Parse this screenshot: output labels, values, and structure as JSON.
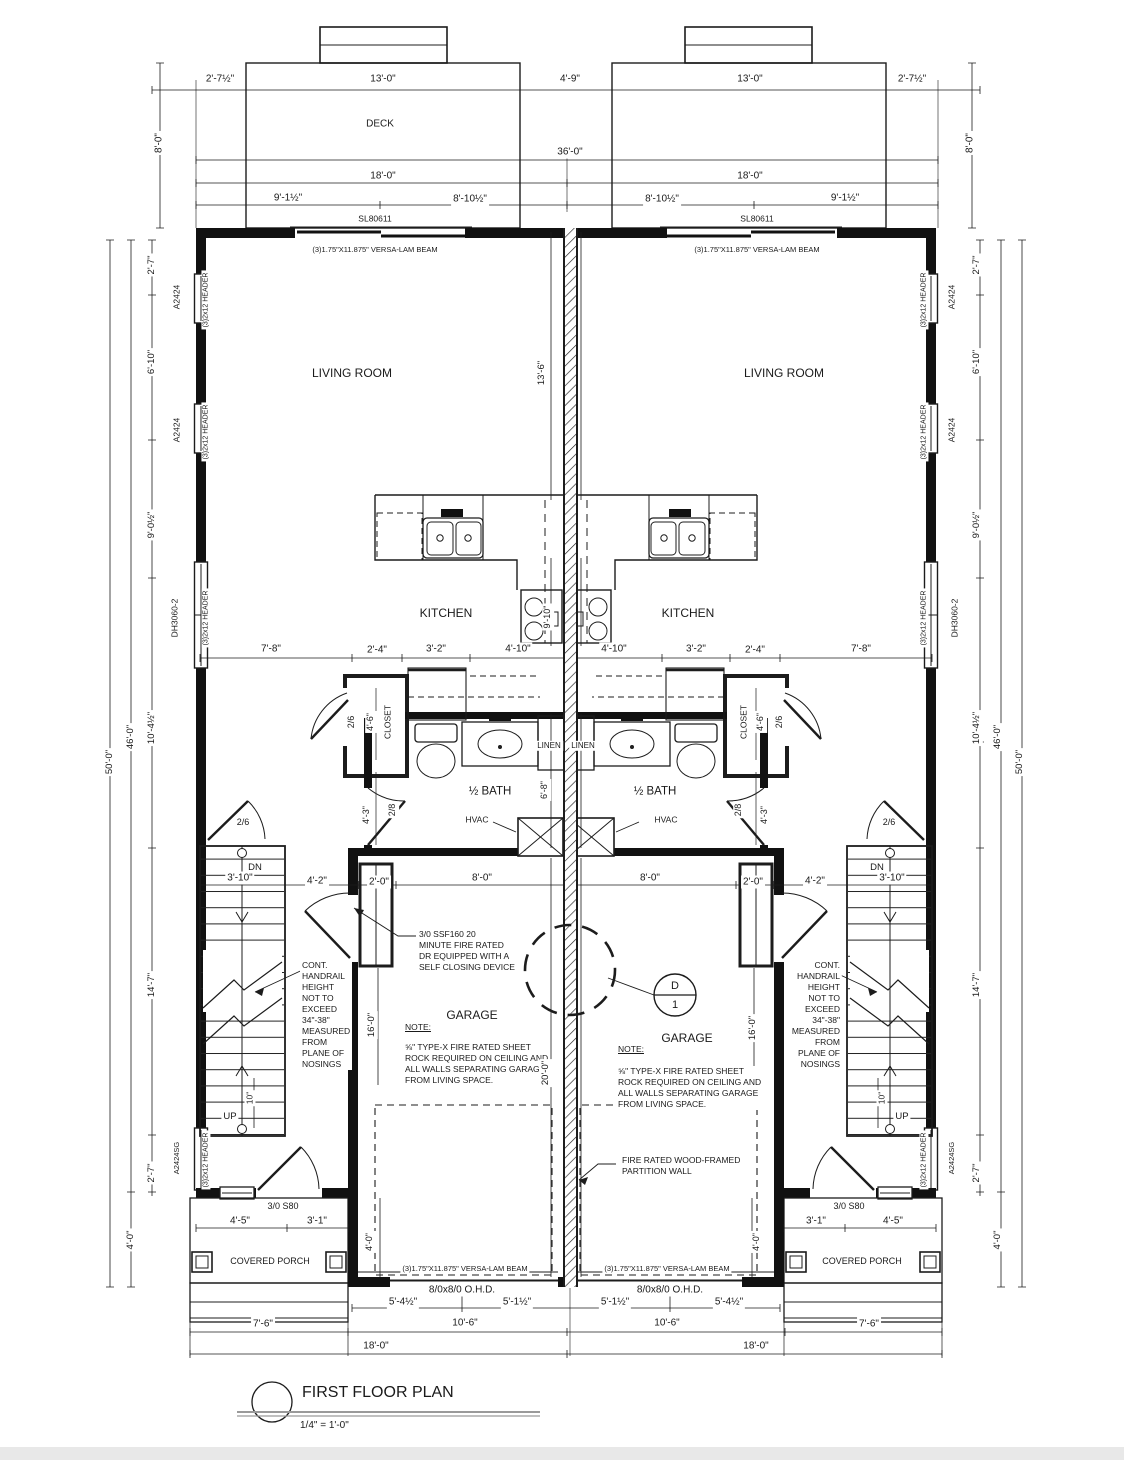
{
  "title": {
    "name": "FIRST FLOOR PLAN",
    "scale": "1/4\" = 1'-0\""
  },
  "rooms": [
    "DECK",
    "LIVING ROOM",
    "KITCHEN",
    "1/2 BATH",
    "CLOSET",
    "LINEN",
    "GARAGE",
    "COVERED PORCH"
  ],
  "notes": {
    "fire_door": "3/0 SSF160 20 MINUTE FIRE RATED DR EQUIPPED WITH A SELF CLOSING DEVICE",
    "garage_note": "5/8\" TYPE-X FIRE RATED SHEET ROCK REQUIRED ON CEILING AND ALL WALLS SEPARATING GARAGE FROM LIVING SPACE.",
    "handrail": "CONT. HANDRAIL HEIGHT NOT TO EXCEED 34\"-38\" MEASURED FROM PLANE OF NOSINGS",
    "partition": "FIRE RATED WOOD-FRAMED PARTITION WALL",
    "beam": "(3)1.75\"X11.875\" VERSA-LAM BEAM",
    "detail_callout": "D/1"
  },
  "labels": [
    {
      "t": "2'-7½\"",
      "x": 220,
      "y": 79
    },
    {
      "t": "13'-0\"",
      "x": 383,
      "y": 79
    },
    {
      "t": "4'-9\"",
      "x": 570,
      "y": 79
    },
    {
      "t": "13'-0\"",
      "x": 750,
      "y": 79
    },
    {
      "t": "2'-7½\"",
      "x": 912,
      "y": 79
    },
    {
      "t": "8'-0\"",
      "x": 159,
      "y": 143,
      "r": -90
    },
    {
      "t": "8'-0\"",
      "x": 970,
      "y": 143,
      "r": -90
    },
    {
      "t": "DECK",
      "x": 380,
      "y": 124,
      "nm": "room-label-deck"
    },
    {
      "t": "36'-0\"",
      "x": 570,
      "y": 152
    },
    {
      "t": "18'-0\"",
      "x": 383,
      "y": 176
    },
    {
      "t": "18'-0\"",
      "x": 750,
      "y": 176
    },
    {
      "t": "9'-1½\"",
      "x": 288,
      "y": 198
    },
    {
      "t": "8'-10½\"",
      "x": 470,
      "y": 199
    },
    {
      "t": "8'-10½\"",
      "x": 662,
      "y": 199
    },
    {
      "t": "9'-1½\"",
      "x": 845,
      "y": 198
    },
    {
      "t": "SL80611",
      "x": 375,
      "y": 219,
      "s": 8.5
    },
    {
      "t": "SL80611",
      "x": 757,
      "y": 219,
      "s": 8.5
    },
    {
      "t": "(3)1.75\"X11.875\" VERSA-LAM BEAM",
      "x": 375,
      "y": 250,
      "s": 7.5
    },
    {
      "t": "(3)1.75\"X11.875\" VERSA-LAM BEAM",
      "x": 757,
      "y": 250,
      "s": 7.5
    },
    {
      "t": "2'-7\"",
      "x": 152,
      "y": 265,
      "r": -90,
      "s": 9.5
    },
    {
      "t": "A2424",
      "x": 177,
      "y": 297,
      "r": -90,
      "s": 8.5
    },
    {
      "t": "(3)2x12 HEADER",
      "x": 206,
      "y": 300,
      "r": -90,
      "s": 7
    },
    {
      "t": "6'-10\"",
      "x": 152,
      "y": 362,
      "r": -90,
      "s": 9.5
    },
    {
      "t": "A2424",
      "x": 177,
      "y": 430,
      "r": -90,
      "s": 8.5
    },
    {
      "t": "(3)2x12 HEADER",
      "x": 206,
      "y": 432,
      "r": -90,
      "s": 7
    },
    {
      "t": "9'-0½\"",
      "x": 152,
      "y": 525,
      "r": -90,
      "s": 9.5
    },
    {
      "t": "DH3060-2",
      "x": 175,
      "y": 618,
      "r": -90,
      "s": 8.5
    },
    {
      "t": "(3)2x12 HEADER",
      "x": 206,
      "y": 618,
      "r": -90,
      "s": 7
    },
    {
      "t": "10'-4½\"",
      "x": 152,
      "y": 728,
      "r": -90,
      "s": 9.5
    },
    {
      "t": "46'-0\"",
      "x": 131,
      "y": 737,
      "r": -90,
      "s": 9.5
    },
    {
      "t": "50'-0\"",
      "x": 110,
      "y": 762,
      "r": -90,
      "s": 9.5
    },
    {
      "t": "14'-7\"",
      "x": 152,
      "y": 985,
      "r": -90,
      "s": 9.5
    },
    {
      "t": "A2424SG",
      "x": 177,
      "y": 1158,
      "r": -90,
      "s": 7.5
    },
    {
      "t": "(3)2x12 HEADER",
      "x": 206,
      "y": 1160,
      "r": -90,
      "s": 7
    },
    {
      "t": "2'-7\"",
      "x": 152,
      "y": 1173,
      "r": -90,
      "s": 9.5
    },
    {
      "t": "4'-0\"",
      "x": 131,
      "y": 1240,
      "r": -90,
      "s": 9.5
    },
    {
      "t": "2'-7\"",
      "x": 977,
      "y": 265,
      "r": -90,
      "s": 9.5
    },
    {
      "t": "A2424",
      "x": 952,
      "y": 297,
      "r": -90,
      "s": 8.5
    },
    {
      "t": "(3)2x12 HEADER",
      "x": 924,
      "y": 300,
      "r": -90,
      "s": 7
    },
    {
      "t": "6'-10\"",
      "x": 977,
      "y": 362,
      "r": -90,
      "s": 9.5
    },
    {
      "t": "A2424",
      "x": 952,
      "y": 430,
      "r": -90,
      "s": 8.5
    },
    {
      "t": "(3)2x12 HEADER",
      "x": 924,
      "y": 432,
      "r": -90,
      "s": 7
    },
    {
      "t": "9'-0½\"",
      "x": 977,
      "y": 525,
      "r": -90,
      "s": 9.5
    },
    {
      "t": "DH3060-2",
      "x": 955,
      "y": 618,
      "r": -90,
      "s": 8.5
    },
    {
      "t": "(3)2x12 HEADER",
      "x": 924,
      "y": 618,
      "r": -90,
      "s": 7
    },
    {
      "t": "10'-4½\"",
      "x": 977,
      "y": 728,
      "r": -90,
      "s": 9.5
    },
    {
      "t": "46'-0\"",
      "x": 998,
      "y": 737,
      "r": -90,
      "s": 9.5
    },
    {
      "t": "50'-0\"",
      "x": 1020,
      "y": 762,
      "r": -90,
      "s": 9.5
    },
    {
      "t": "14'-7\"",
      "x": 977,
      "y": 985,
      "r": -90,
      "s": 9.5
    },
    {
      "t": "A2424SG",
      "x": 952,
      "y": 1158,
      "r": -90,
      "s": 7.5
    },
    {
      "t": "(3)2x12 HEADER",
      "x": 924,
      "y": 1160,
      "r": -90,
      "s": 7
    },
    {
      "t": "2'-7\"",
      "x": 977,
      "y": 1173,
      "r": -90,
      "s": 9.5
    },
    {
      "t": "4'-0\"",
      "x": 998,
      "y": 1240,
      "r": -90,
      "s": 9.5
    },
    {
      "t": "LIVING ROOM",
      "x": 352,
      "y": 374,
      "s": 12,
      "nm": "room-label-living-left"
    },
    {
      "t": "LIVING ROOM",
      "x": 784,
      "y": 374,
      "s": 12,
      "nm": "room-label-living-right"
    },
    {
      "t": "13'-6\"",
      "x": 542,
      "y": 373,
      "r": -90,
      "s": 9.5
    },
    {
      "t": "KITCHEN",
      "x": 446,
      "y": 614,
      "s": 12,
      "nm": "room-label-kitchen-left"
    },
    {
      "t": "KITCHEN",
      "x": 688,
      "y": 614,
      "s": 12,
      "nm": "room-label-kitchen-right"
    },
    {
      "t": "9'-10\"",
      "x": 548,
      "y": 617,
      "r": -90,
      "s": 9
    },
    {
      "t": "7'-8\"",
      "x": 271,
      "y": 649
    },
    {
      "t": "2'-4\"",
      "x": 377,
      "y": 650
    },
    {
      "t": "3'-2\"",
      "x": 436,
      "y": 649
    },
    {
      "t": "4'-10\"",
      "x": 518,
      "y": 649
    },
    {
      "t": "4'-10\"",
      "x": 614,
      "y": 649
    },
    {
      "t": "3'-2\"",
      "x": 696,
      "y": 649
    },
    {
      "t": "2'-4\"",
      "x": 755,
      "y": 650
    },
    {
      "t": "7'-8\"",
      "x": 861,
      "y": 649
    },
    {
      "t": "2/6",
      "x": 352,
      "y": 722,
      "r": -90,
      "s": 9
    },
    {
      "t": "4'-6\"",
      "x": 371,
      "y": 722,
      "r": -90,
      "s": 9
    },
    {
      "t": "CLOSET",
      "x": 388,
      "y": 722,
      "r": -90,
      "s": 8.5,
      "nm": "room-label-closet-left"
    },
    {
      "t": "2/6",
      "x": 780,
      "y": 722,
      "r": -90,
      "s": 9
    },
    {
      "t": "4'-6\"",
      "x": 761,
      "y": 722,
      "r": -90,
      "s": 9
    },
    {
      "t": "CLOSET",
      "x": 744,
      "y": 722,
      "r": -90,
      "s": 8.5,
      "nm": "room-label-closet-right"
    },
    {
      "t": "LINEN",
      "x": 549,
      "y": 746,
      "s": 8,
      "nm": "room-label-linen-left"
    },
    {
      "t": "LINEN",
      "x": 583,
      "y": 746,
      "s": 8,
      "nm": "room-label-linen-right"
    },
    {
      "t": "½ BATH",
      "x": 490,
      "y": 792,
      "s": 11.5,
      "nm": "room-label-bath-left"
    },
    {
      "t": "½ BATH",
      "x": 655,
      "y": 792,
      "s": 11.5,
      "nm": "room-label-bath-right"
    },
    {
      "t": "6'-8\"",
      "x": 545,
      "y": 790,
      "r": -90,
      "s": 9
    },
    {
      "t": "4'-3\"",
      "x": 367,
      "y": 815,
      "r": -90,
      "s": 9
    },
    {
      "t": "2/8",
      "x": 393,
      "y": 810,
      "r": -90,
      "s": 9
    },
    {
      "t": "4'-3\"",
      "x": 765,
      "y": 815,
      "r": -90,
      "s": 9
    },
    {
      "t": "2/8",
      "x": 739,
      "y": 810,
      "r": -90,
      "s": 9
    },
    {
      "t": "HVAC",
      "x": 477,
      "y": 820,
      "s": 8.5
    },
    {
      "t": "HVAC",
      "x": 666,
      "y": 820,
      "s": 8.5
    },
    {
      "t": "2/6",
      "x": 243,
      "y": 823,
      "s": 9
    },
    {
      "t": "2/6",
      "x": 889,
      "y": 823,
      "s": 9
    },
    {
      "t": "DN",
      "x": 255,
      "y": 868,
      "s": 9.5
    },
    {
      "t": "DN",
      "x": 877,
      "y": 868,
      "s": 9.5
    },
    {
      "t": "3'-10\"",
      "x": 240,
      "y": 878
    },
    {
      "t": "4'-2\"",
      "x": 317,
      "y": 881
    },
    {
      "t": "2'-0\"",
      "x": 379,
      "y": 882
    },
    {
      "t": "8'-0\"",
      "x": 482,
      "y": 878
    },
    {
      "t": "8'-0\"",
      "x": 650,
      "y": 878
    },
    {
      "t": "2'-0\"",
      "x": 753,
      "y": 882
    },
    {
      "t": "4'-2\"",
      "x": 815,
      "y": 881
    },
    {
      "t": "3'-10\"",
      "x": 892,
      "y": 878
    },
    {
      "t": "UP",
      "x": 230,
      "y": 1117,
      "s": 9.5
    },
    {
      "t": "UP",
      "x": 902,
      "y": 1117,
      "s": 9.5
    },
    {
      "t": "10\"",
      "x": 250,
      "y": 1098,
      "r": -90,
      "s": 8.5
    },
    {
      "t": "10\"",
      "x": 882,
      "y": 1098,
      "r": -90,
      "s": 8.5
    },
    {
      "t": "CONT.\nHANDRAIL\nHEIGHT\nNOT TO\nEXCEED\n34\"-38\"\nMEASURED\nFROM\nPLANE OF\nNOSINGS",
      "x": 300,
      "y": 960,
      "al": "tl",
      "s": 8.5,
      "nm": "note-handrail-left"
    },
    {
      "t": "CONT.\nHANDRAIL\nHEIGHT\nNOT TO\nEXCEED\n34\"-38\"\nMEASURED\nFROM\nPLANE OF\nNOSINGS",
      "x": 842,
      "y": 960,
      "al": "tr",
      "s": 8.5,
      "nm": "note-handrail-right"
    },
    {
      "t": "3/0 SSF160 20\nMINUTE FIRE RATED\nDR EQUIPPED WITH A\nSELF CLOSING DEVICE",
      "x": 417,
      "y": 929,
      "al": "tl",
      "s": 8.5,
      "nm": "note-fire-door"
    },
    {
      "t": "GARAGE",
      "x": 472,
      "y": 1016,
      "s": 12,
      "nm": "room-label-garage-left"
    },
    {
      "t": "GARAGE",
      "x": 687,
      "y": 1039,
      "s": 12,
      "nm": "room-label-garage-right"
    },
    {
      "t": "NOTE:",
      "x": 403,
      "y": 1022,
      "al": "tl",
      "s": 8.5,
      "u": 1
    },
    {
      "t": "NOTE:",
      "x": 616,
      "y": 1044,
      "al": "tl",
      "s": 8.5,
      "u": 1
    },
    {
      "t": "⅝\" TYPE-X FIRE RATED SHEET\nROCK REQUIRED ON CEILING AND\nALL WALLS SEPARATING GARAGE\nFROM LIVING SPACE.",
      "x": 403,
      "y": 1042,
      "al": "tl",
      "s": 8.5,
      "nm": "note-garage-left"
    },
    {
      "t": "⅝\" TYPE-X FIRE RATED SHEET\nROCK REQUIRED ON CEILING AND\nALL WALLS SEPARATING GARAGE\nFROM LIVING SPACE.",
      "x": 616,
      "y": 1066,
      "al": "tl",
      "s": 8.5,
      "nm": "note-garage-right"
    },
    {
      "t": "16'-0\"",
      "x": 372,
      "y": 1025,
      "r": -90,
      "s": 9.5
    },
    {
      "t": "16'-0\"",
      "x": 753,
      "y": 1028,
      "r": -90,
      "s": 9.5
    },
    {
      "t": "20'-0\"",
      "x": 546,
      "y": 1073,
      "r": -90,
      "s": 9.5
    },
    {
      "t": "FIRE RATED WOOD-FRAMED\nPARTITION WALL",
      "x": 620,
      "y": 1155,
      "al": "tl",
      "s": 8.5,
      "nm": "note-partition-wall"
    },
    {
      "t": "D",
      "x": 675,
      "y": 986,
      "s": 11,
      "nm": "detail-callout-letter"
    },
    {
      "t": "1",
      "x": 675,
      "y": 1005,
      "s": 11,
      "nm": "detail-callout-number"
    },
    {
      "t": "3/0 S80",
      "x": 283,
      "y": 1207,
      "s": 9
    },
    {
      "t": "3/0 S80",
      "x": 849,
      "y": 1207,
      "s": 9
    },
    {
      "t": "4'-5\"",
      "x": 240,
      "y": 1221
    },
    {
      "t": "3'-1\"",
      "x": 317,
      "y": 1221
    },
    {
      "t": "3'-1\"",
      "x": 816,
      "y": 1221
    },
    {
      "t": "4'-5\"",
      "x": 893,
      "y": 1221
    },
    {
      "t": "COVERED PORCH",
      "x": 270,
      "y": 1262,
      "s": 9,
      "nm": "room-label-porch-left"
    },
    {
      "t": "COVERED PORCH",
      "x": 862,
      "y": 1262,
      "s": 9,
      "nm": "room-label-porch-right"
    },
    {
      "t": "4'-0\"",
      "x": 370,
      "y": 1242,
      "r": -90,
      "s": 9
    },
    {
      "t": "4'-0\"",
      "x": 757,
      "y": 1242,
      "r": -90,
      "s": 9
    },
    {
      "t": "(3)1.75\"X11.875\" VERSA-LAM BEAM",
      "x": 465,
      "y": 1269,
      "s": 7.5
    },
    {
      "t": "(3)1.75\"X11.875\" VERSA-LAM BEAM",
      "x": 667,
      "y": 1269,
      "s": 7.5
    },
    {
      "t": "8/0x8/0 O.H.D.",
      "x": 462,
      "y": 1290,
      "s": 10
    },
    {
      "t": "8/0x8/0 O.H.D.",
      "x": 670,
      "y": 1290,
      "s": 10
    },
    {
      "t": "5'-4½\"",
      "x": 403,
      "y": 1302
    },
    {
      "t": "5'-1½\"",
      "x": 517,
      "y": 1302
    },
    {
      "t": "5'-1½\"",
      "x": 615,
      "y": 1302
    },
    {
      "t": "5'-4½\"",
      "x": 729,
      "y": 1302
    },
    {
      "t": "7'-6\"",
      "x": 263,
      "y": 1324
    },
    {
      "t": "10'-6\"",
      "x": 465,
      "y": 1323
    },
    {
      "t": "10'-6\"",
      "x": 667,
      "y": 1323
    },
    {
      "t": "7'-6\"",
      "x": 869,
      "y": 1324
    },
    {
      "t": "18'-0\"",
      "x": 376,
      "y": 1346
    },
    {
      "t": "18'-0\"",
      "x": 756,
      "y": 1346
    },
    {
      "t": "FIRST FLOOR PLAN",
      "x": 300,
      "y": 1383,
      "al": "tl",
      "s": 16,
      "nm": "drawing-title"
    },
    {
      "t": "1/4\" = 1'-0\"",
      "x": 298,
      "y": 1419,
      "al": "tl",
      "s": 10,
      "nm": "drawing-scale"
    }
  ]
}
